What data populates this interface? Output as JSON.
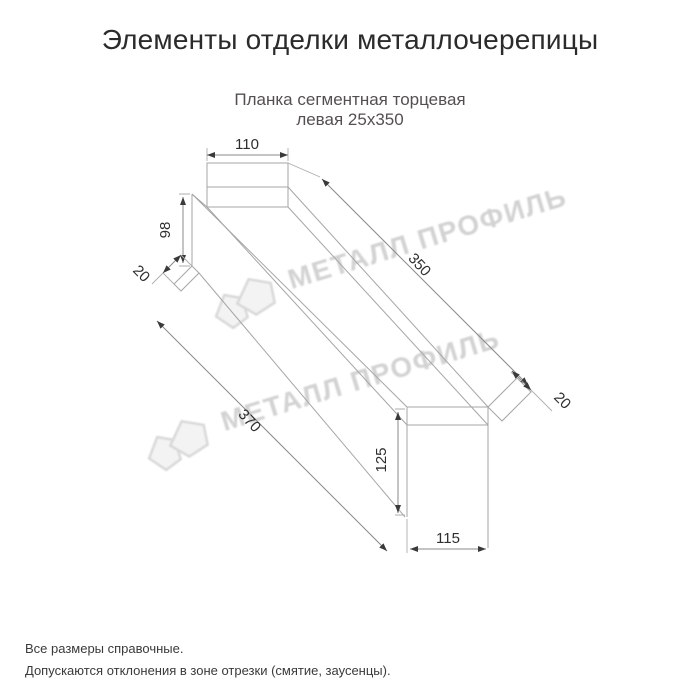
{
  "page": {
    "title": "Элементы отделки металлочерепицы",
    "background": "#ffffff"
  },
  "product": {
    "subtitle_line1": "Планка сегментная торцевая",
    "subtitle_line2": "левая 25x350"
  },
  "diagram": {
    "type": "isometric technical drawing of a left segment end (verge) trim strip",
    "dimensions": {
      "top_width": "110",
      "left_height": "98",
      "left_hem": "20",
      "top_length": "350",
      "bottom_length": "370",
      "right_hem": "20",
      "right_height": "125",
      "bottom_width": "115"
    },
    "colors": {
      "outline": "#a6a6a6",
      "dimension_text": "#2e2e2e",
      "title": "#2b2b2b",
      "subtitle": "#555050",
      "watermark": "#cbcbcb"
    }
  },
  "watermark": {
    "text": "МЕТАЛЛ ПРОФИЛЬ"
  },
  "footer": {
    "line1": "Все размеры справочные.",
    "line2": "Допускаются отклонения в зоне отрезки (смятие, заусенцы)."
  }
}
